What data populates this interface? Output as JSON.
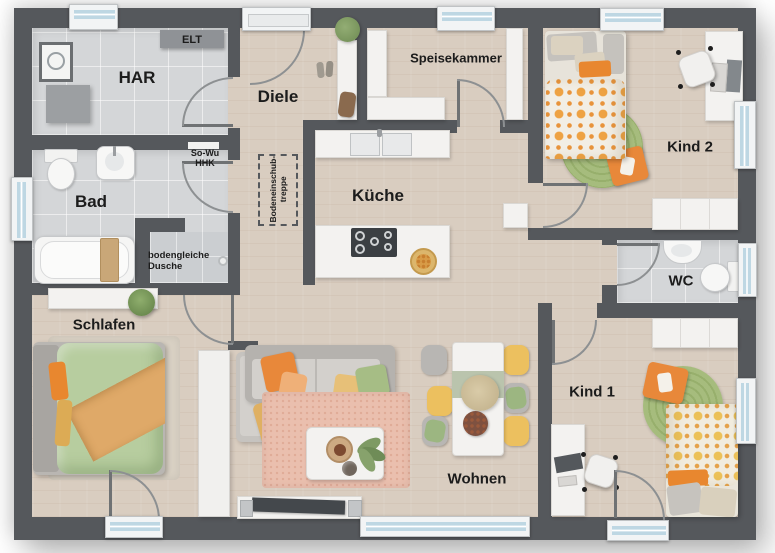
{
  "plan": {
    "type": "floor-plan",
    "rooms": {
      "har": {
        "label": "HAR"
      },
      "diele": {
        "label": "Diele"
      },
      "bad": {
        "label": "Bad"
      },
      "kueche": {
        "label": "Küche"
      },
      "speisekammer": {
        "label": "Speisekammer"
      },
      "kind2": {
        "label": "Kind 2"
      },
      "wc": {
        "label": "WC"
      },
      "kind1": {
        "label": "Kind 1"
      },
      "wohnen": {
        "label": "Wohnen"
      },
      "schlafen": {
        "label": "Schlafen"
      }
    },
    "annotations": {
      "elt": "ELT",
      "so_wu": {
        "line1": "So-Wu",
        "line2": "HHK"
      },
      "dusche": {
        "line1": "bodengleiche",
        "line2": "Dusche"
      },
      "treppe": {
        "line1": "Bodeneinschub-",
        "line2": "treppe"
      }
    },
    "colors": {
      "wall": "#55585c",
      "wood_floor": "#d9cdc0",
      "tile_floor": "#d4d6d8",
      "accent_orange": "#e8872f",
      "accent_yellow": "#ecc05f",
      "rug_green": "#a6bc7d",
      "rug_pink": "#eabfae",
      "duvet_green": "#b7cd9f",
      "sofa_gray": "#c6c3bf",
      "window_glass": "#bed7e3"
    }
  }
}
